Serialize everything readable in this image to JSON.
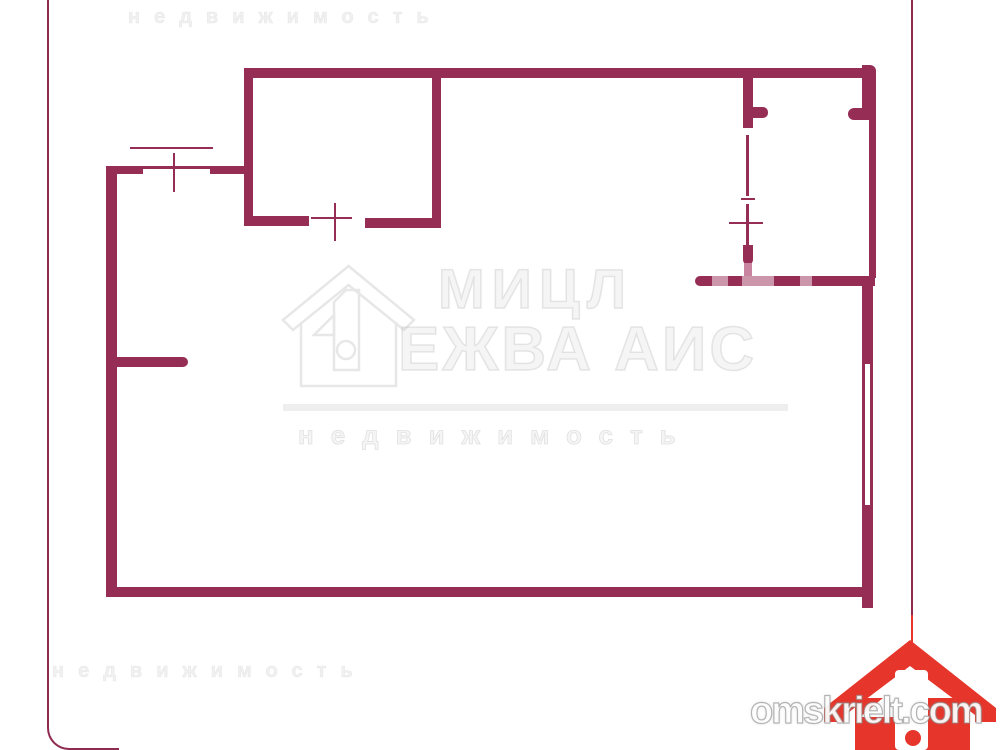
{
  "palette": {
    "wall": "#962D55",
    "faded": "#C9849F",
    "wash": "rgba(255,255,255,0.5)",
    "frame": "#8F2B51",
    "logo_red": "#E6352B",
    "watermark_gray": "rgba(200,200,200,0.42)"
  },
  "watermark_site": {
    "text": "omskrielt.com"
  },
  "watermark_center": {
    "legibility": "very-low, approximated strokes",
    "line1": "МИЦЛ",
    "line2": "ЕЖВА АИС",
    "line3": "недвижимость"
  },
  "floorplan": {
    "description": "apartment floor plan drawn with thick maroon walls",
    "rects": [
      {
        "name": "top-wall",
        "x": 244,
        "y": 68,
        "w": 632,
        "h": 10,
        "c": "wall",
        "r": "0 6px 0 0"
      },
      {
        "name": "room1-left-wall",
        "x": 244,
        "y": 68,
        "w": 9,
        "h": 158,
        "c": "wall"
      },
      {
        "name": "room1-bottom-wall-left",
        "x": 244,
        "y": 216,
        "w": 65,
        "h": 10,
        "c": "wall",
        "r": "0 0 0 6px"
      },
      {
        "name": "room1-bottom-wall-right",
        "x": 365,
        "y": 218,
        "w": 76,
        "h": 10,
        "c": "wall"
      },
      {
        "name": "room1-right-wall",
        "x": 432,
        "y": 68,
        "w": 9,
        "h": 160,
        "c": "wall"
      },
      {
        "name": "room1-door-tick-v",
        "x": 334,
        "y": 203,
        "w": 2,
        "h": 38,
        "c": "wall"
      },
      {
        "name": "room1-door-tick-h",
        "x": 311,
        "y": 217,
        "w": 41,
        "h": 2,
        "c": "wall"
      },
      {
        "name": "hall-top-wall-left",
        "x": 106,
        "y": 166,
        "w": 37,
        "h": 8,
        "c": "wall"
      },
      {
        "name": "hall-window-sill-line",
        "x": 143,
        "y": 166,
        "w": 67,
        "h": 3,
        "c": "wall"
      },
      {
        "name": "hall-window-outer-line",
        "x": 130,
        "y": 147,
        "w": 83,
        "h": 2,
        "c": "wall"
      },
      {
        "name": "hall-window-tick-v",
        "x": 173,
        "y": 153,
        "w": 2,
        "h": 39,
        "c": "wall"
      },
      {
        "name": "hall-top-wall-right",
        "x": 210,
        "y": 166,
        "w": 34,
        "h": 8,
        "c": "wall"
      },
      {
        "name": "left-outer-wall",
        "x": 106,
        "y": 166,
        "w": 11,
        "h": 431,
        "c": "wall",
        "r": "0 0 0 8px"
      },
      {
        "name": "interior-stub-wall",
        "x": 117,
        "y": 357,
        "w": 71,
        "h": 10,
        "c": "wall",
        "r": "0 5px 5px 0"
      },
      {
        "name": "bottom-wall",
        "x": 106,
        "y": 587,
        "w": 767,
        "h": 10,
        "c": "wall"
      },
      {
        "name": "right-wall-bottom-stub",
        "x": 862,
        "y": 597,
        "w": 11,
        "h": 11,
        "c": "wall"
      },
      {
        "name": "right-wall-lower",
        "x": 862,
        "y": 505,
        "w": 11,
        "h": 84,
        "c": "wall"
      },
      {
        "name": "right-window-outer-line",
        "x": 870,
        "y": 362,
        "w": 3,
        "h": 143,
        "c": "wall"
      },
      {
        "name": "right-window-inner-line",
        "x": 862,
        "y": 362,
        "w": 3,
        "h": 143,
        "c": "wall"
      },
      {
        "name": "right-wall-mid",
        "x": 862,
        "y": 276,
        "w": 11,
        "h": 88,
        "c": "wall"
      },
      {
        "name": "right-wall-upper",
        "x": 869,
        "y": 118,
        "w": 7,
        "h": 160,
        "c": "wall"
      },
      {
        "name": "right-wall-top",
        "x": 862,
        "y": 65,
        "w": 14,
        "h": 55,
        "c": "wall",
        "r": "0 6px 0 0"
      },
      {
        "name": "right-doorway-stub",
        "x": 848,
        "y": 108,
        "w": 27,
        "h": 12,
        "c": "wall",
        "r": "6px 0 0 6px"
      },
      {
        "name": "partition-wall-top",
        "x": 743,
        "y": 68,
        "w": 10,
        "h": 60,
        "c": "wall"
      },
      {
        "name": "partition-doorway-stub",
        "x": 753,
        "y": 107,
        "w": 15,
        "h": 11,
        "c": "wall",
        "r": "0 5px 5px 0"
      },
      {
        "name": "partition-door-line-a",
        "x": 746,
        "y": 135,
        "w": 3,
        "h": 61,
        "c": "wall"
      },
      {
        "name": "partition-door-line-b",
        "x": 746,
        "y": 204,
        "w": 3,
        "h": 41,
        "c": "wall"
      },
      {
        "name": "partition-door-tick",
        "x": 741,
        "y": 198,
        "w": 14,
        "h": 2,
        "c": "wall"
      },
      {
        "name": "partition-cross-tick",
        "x": 729,
        "y": 222,
        "w": 34,
        "h": 2,
        "c": "wall"
      },
      {
        "name": "partition-wall-bottom",
        "x": 743,
        "y": 245,
        "w": 10,
        "h": 19,
        "c": "wall",
        "r": "0 0 4px 4px"
      },
      {
        "name": "partition-wall-faded",
        "x": 744,
        "y": 263,
        "w": 8,
        "h": 14,
        "c": "faded"
      },
      {
        "name": "inner-wall-horizontal",
        "x": 695,
        "y": 276,
        "w": 180,
        "h": 10,
        "c": "wall",
        "r": "5px 0 0 5px"
      },
      {
        "name": "inner-wall-wash-1",
        "x": 712,
        "y": 276,
        "w": 16,
        "h": 10,
        "c": "wash"
      },
      {
        "name": "inner-wall-wash-2",
        "x": 742,
        "y": 276,
        "w": 32,
        "h": 10,
        "c": "wash"
      },
      {
        "name": "inner-wall-wash-3",
        "x": 800,
        "y": 276,
        "w": 12,
        "h": 10,
        "c": "wash"
      }
    ]
  }
}
